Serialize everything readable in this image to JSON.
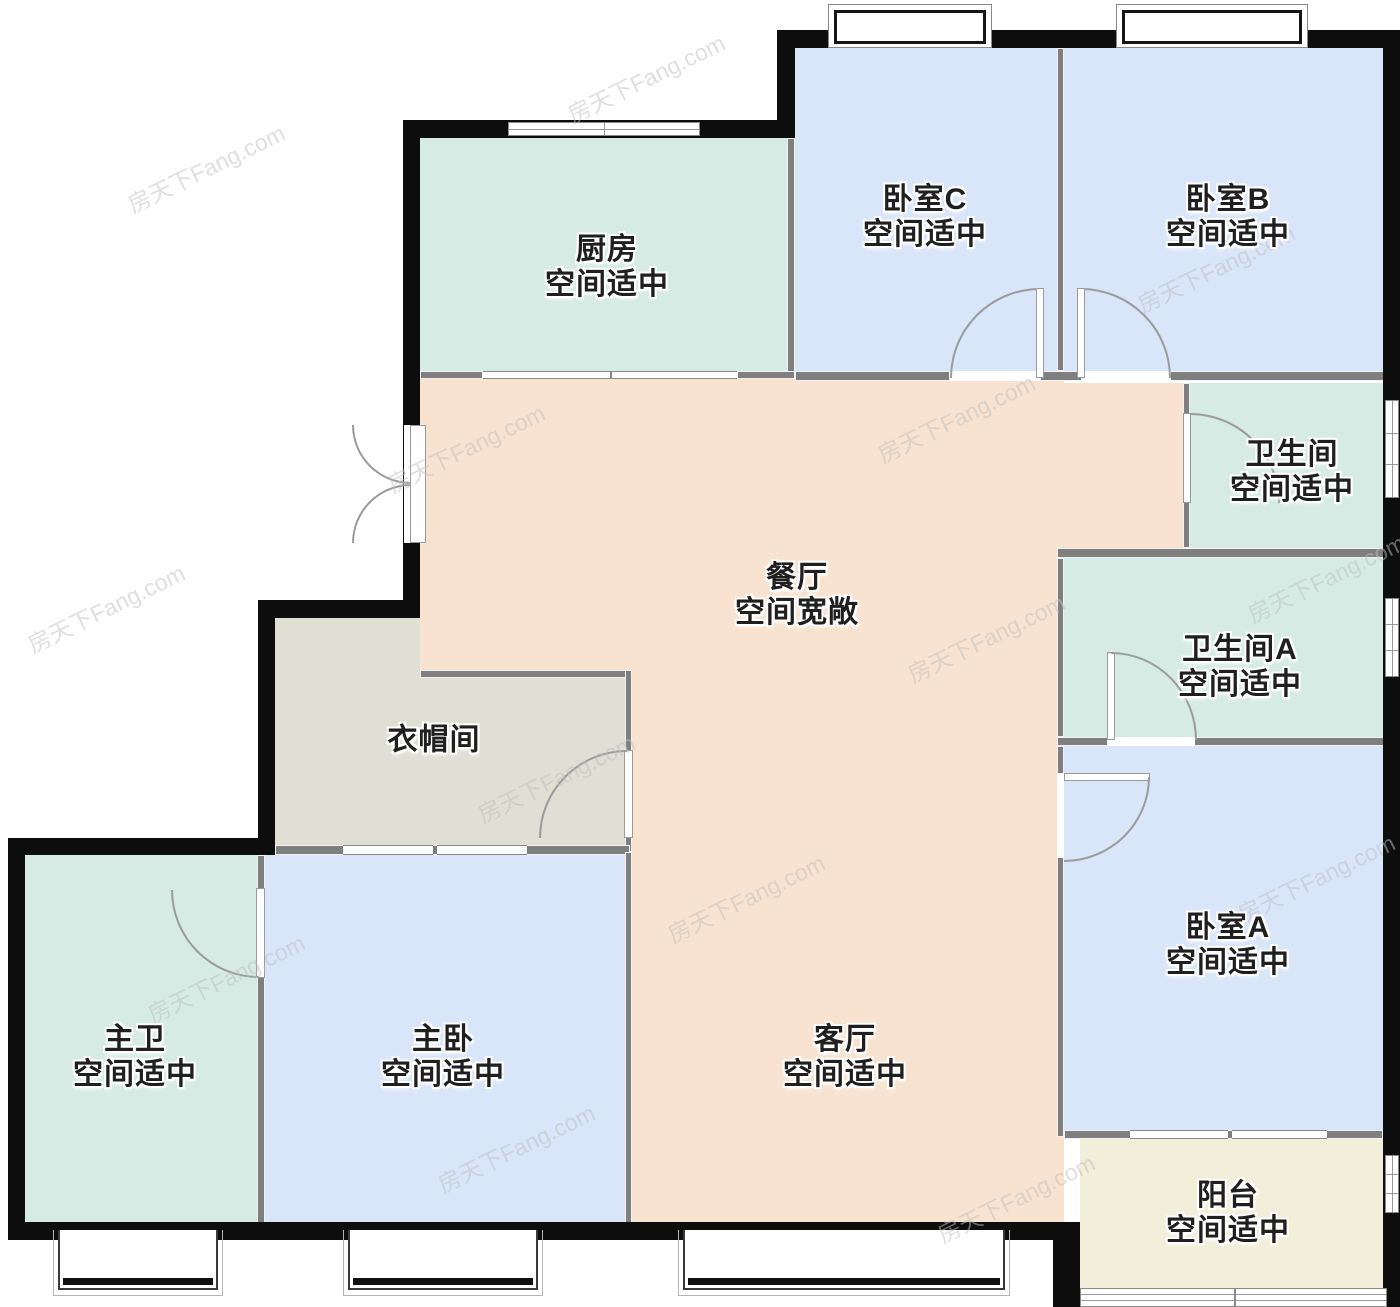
{
  "watermark": "房天下Fang.com",
  "rooms": [
    {
      "id": "kitchen",
      "name": "厨房",
      "note": "空间适中"
    },
    {
      "id": "bedroom-c",
      "name": "卧室C",
      "note": "空间适中"
    },
    {
      "id": "bedroom-b",
      "name": "卧室B",
      "note": "空间适中"
    },
    {
      "id": "bathroom",
      "name": "卫生间",
      "note": "空间适中"
    },
    {
      "id": "dining-room",
      "name": "餐厅",
      "note": "空间宽敞"
    },
    {
      "id": "bathroom-a",
      "name": "卫生间A",
      "note": "空间适中"
    },
    {
      "id": "cloakroom",
      "name": "衣帽间",
      "note": ""
    },
    {
      "id": "bedroom-a",
      "name": "卧室A",
      "note": "空间适中"
    },
    {
      "id": "master-bath",
      "name": "主卫",
      "note": "空间适中"
    },
    {
      "id": "master-bedroom",
      "name": "主卧",
      "note": "空间适中"
    },
    {
      "id": "living-room",
      "name": "客厅",
      "note": "空间适中"
    },
    {
      "id": "balcony",
      "name": "阳台",
      "note": "空间适中"
    }
  ],
  "colors": {
    "blue": "#d9e5f8",
    "teal": "#d6ebe3",
    "peach": "#f7e3cf",
    "cloak": "#dfdfd3",
    "balcony": "#f1eeda",
    "wallOuter": "#0d0d0d",
    "wallInner": "#7f7f7f",
    "doorStroke": "#9b9b9b",
    "label": "#1f1f1f",
    "watermark": "#c0c0c0"
  }
}
